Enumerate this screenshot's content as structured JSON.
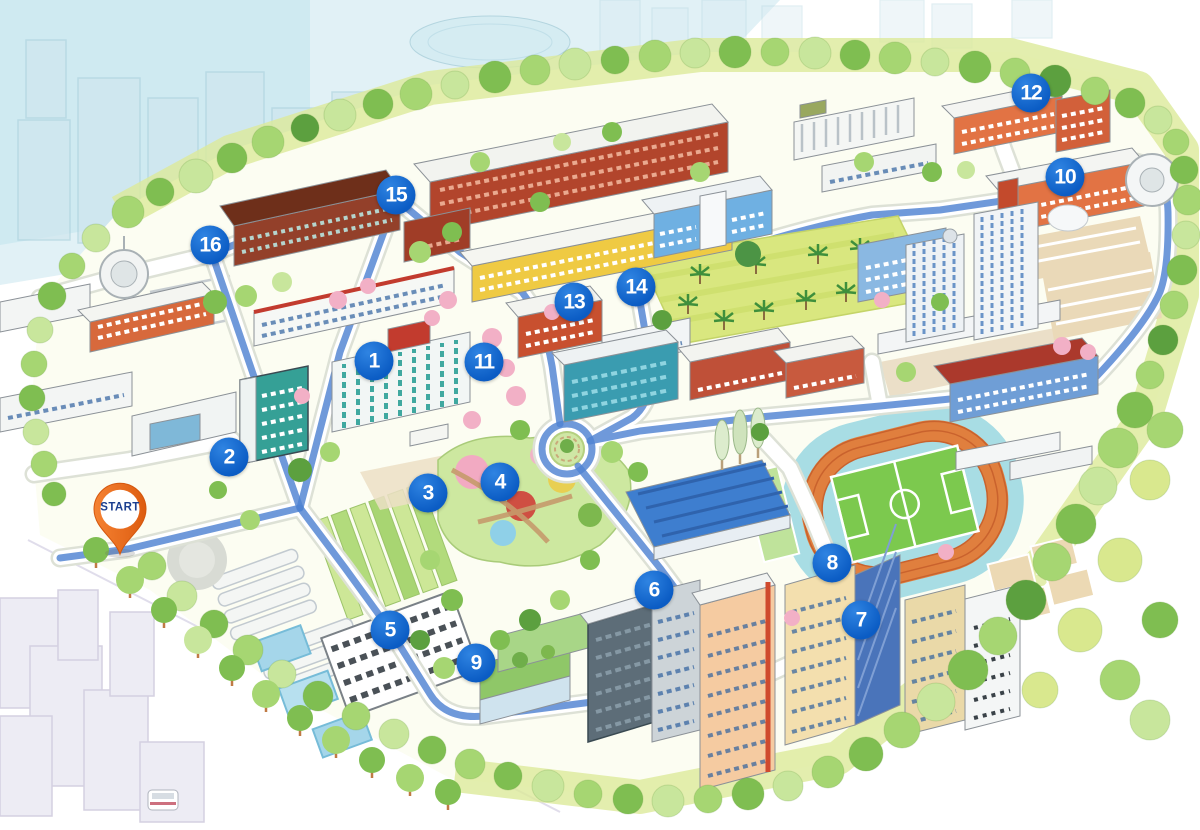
{
  "title": "Illustrated campus walking-tour map",
  "start": {
    "label": "START",
    "x": 120,
    "y": 556
  },
  "markers": [
    {
      "n": "1",
      "x": 374,
      "y": 361
    },
    {
      "n": "2",
      "x": 229,
      "y": 457
    },
    {
      "n": "3",
      "x": 428,
      "y": 493
    },
    {
      "n": "4",
      "x": 500,
      "y": 482
    },
    {
      "n": "5",
      "x": 390,
      "y": 630
    },
    {
      "n": "6",
      "x": 654,
      "y": 590
    },
    {
      "n": "7",
      "x": 861,
      "y": 620
    },
    {
      "n": "8",
      "x": 832,
      "y": 563
    },
    {
      "n": "9",
      "x": 476,
      "y": 663
    },
    {
      "n": "10",
      "x": 1065,
      "y": 177
    },
    {
      "n": "11",
      "x": 484,
      "y": 362
    },
    {
      "n": "12",
      "x": 1031,
      "y": 93
    },
    {
      "n": "13",
      "x": 574,
      "y": 302
    },
    {
      "n": "14",
      "x": 636,
      "y": 287
    },
    {
      "n": "15",
      "x": 396,
      "y": 195
    },
    {
      "n": "16",
      "x": 210,
      "y": 245
    }
  ],
  "colors": {
    "marker_blue": "#0b5cc4",
    "route_blue": "#4f82d2",
    "pin_orange": "#ee6a1d",
    "pin_text": "#1c3f8f"
  }
}
